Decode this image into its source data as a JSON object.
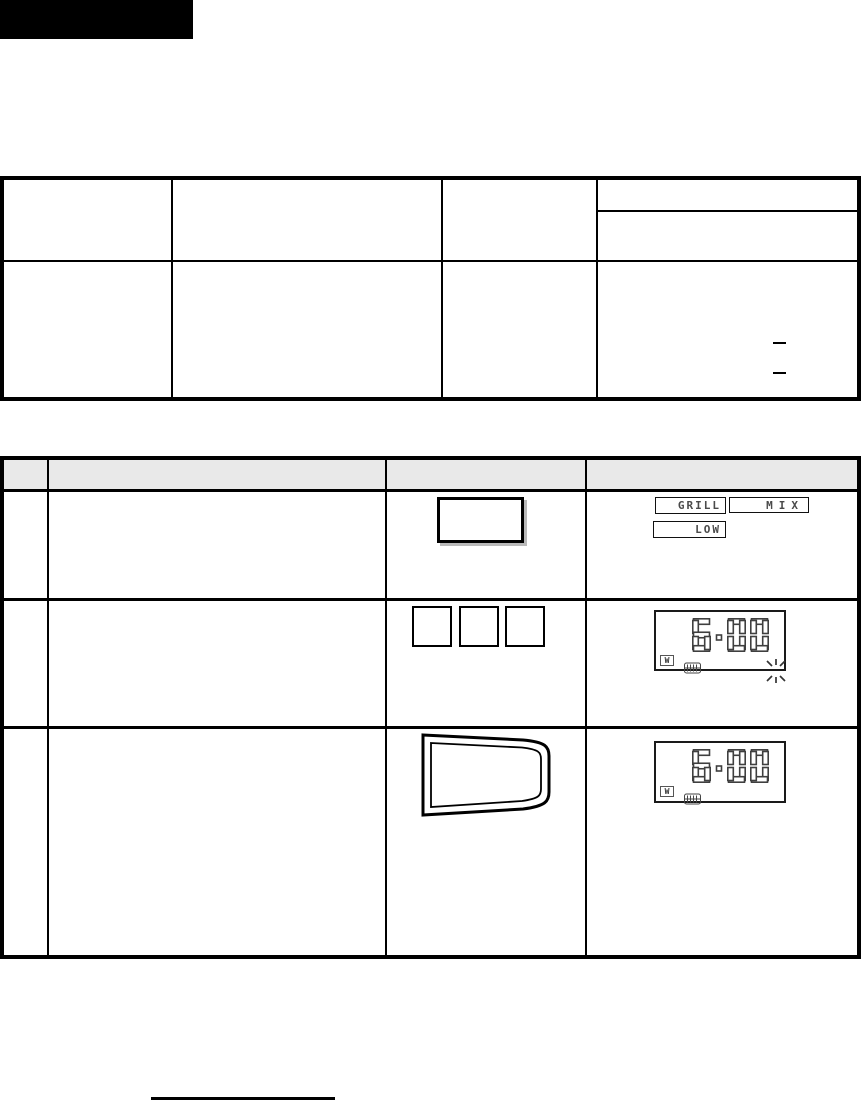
{
  "colors": {
    "ink": "#000000",
    "header_band_bg": "#e9e9e9",
    "lcd_ink": "#3f3f3f",
    "key_shadow": "#b9b9b9"
  },
  "steps_table": {
    "step1": {
      "display_indicators": [
        "GRILL",
        "MIX",
        "LOW"
      ]
    },
    "step2": {
      "display": {
        "time": "6:00",
        "watt_indicator": "W",
        "blinking": true
      }
    },
    "step3": {
      "display": {
        "time": "6:00",
        "watt_indicator": "W",
        "blinking": false
      }
    }
  }
}
